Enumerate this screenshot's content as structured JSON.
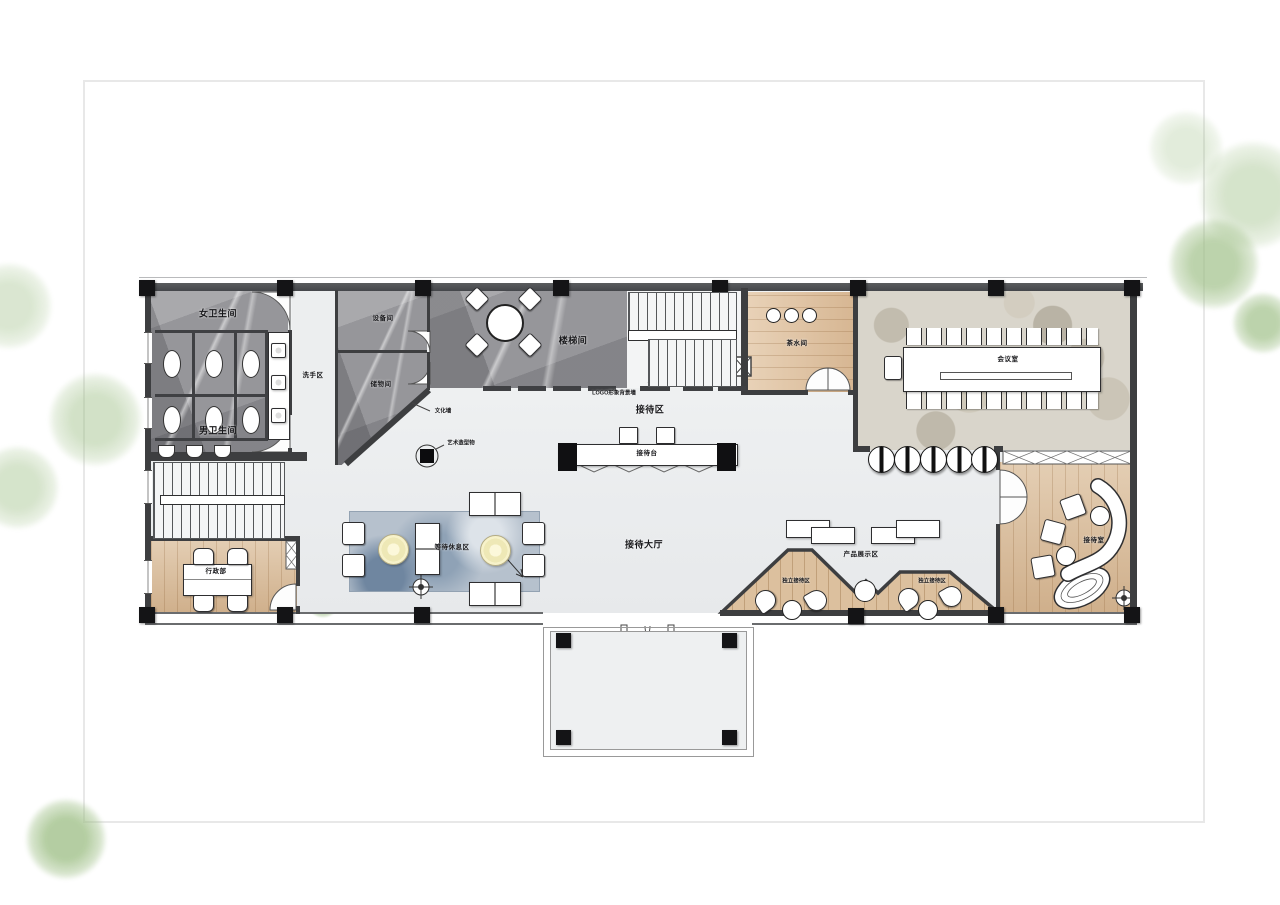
{
  "page": {
    "background": "#ffffff",
    "border_color": "#e8e8e8"
  },
  "plan": {
    "rooms": {
      "women_restroom": "女卫生间",
      "men_restroom": "男卫生间",
      "wash_area": "洗手区",
      "equipment_room": "设备间",
      "storage_room": "储物间",
      "stair_hall": "楼梯间",
      "tea_room": "茶水间",
      "meeting_room": "会议室",
      "reception_zone": "接待区",
      "reception_desk": "接待台",
      "reception_hall": "接待大厅",
      "waiting_lounge": "等待休息区",
      "admin_dept": "行政部",
      "product_display": "产品展示区",
      "private_reception_left": "独立接待区",
      "private_reception_right": "独立接待区",
      "reception_room": "接待室"
    },
    "annotations": {
      "culture_wall": "文化墙",
      "logo_wall": "LOGO形象背景墙",
      "sculpture": "艺术造型物"
    },
    "colors": {
      "wall": "#3d3e40",
      "column": "#141416",
      "marble_floor": "#96969a",
      "wood_floor": "#dcc09e",
      "rug": "#b6c1cd",
      "pebble_floor": "#d9d5cb",
      "hall_floor": "#eef0f1",
      "tree_green": "#9ebf86",
      "coffee_table_yellow": "#f2ecc4"
    }
  }
}
